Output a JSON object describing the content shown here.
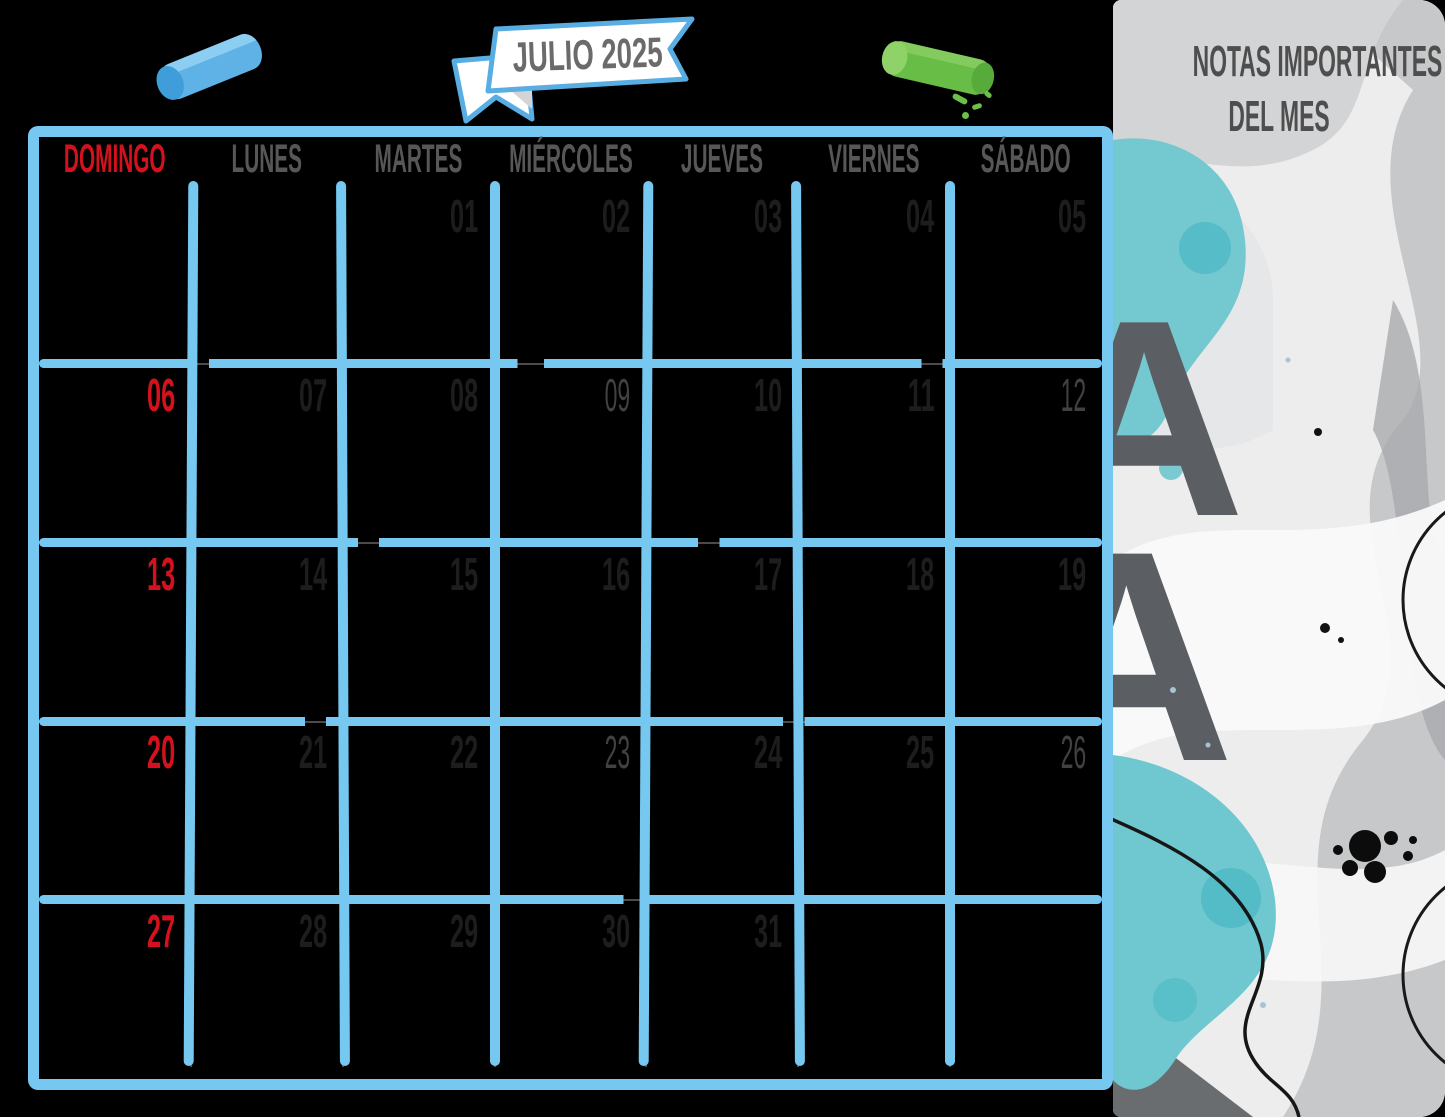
{
  "banner": {
    "title": "JULIO 2025"
  },
  "calendar": {
    "weekdays": [
      {
        "label": "DOMINGO"
      },
      {
        "label": "LUNES"
      },
      {
        "label": "MARTES"
      },
      {
        "label": "MIÉRCOLES"
      },
      {
        "label": "JUEVES"
      },
      {
        "label": "VIERNES"
      },
      {
        "label": "SÁBADO"
      }
    ],
    "weeks": [
      [
        "",
        "",
        "01",
        "02",
        "03",
        "04",
        "05"
      ],
      [
        "06",
        "07",
        "08",
        "09",
        "10",
        "11",
        "12"
      ],
      [
        "13",
        "14",
        "15",
        "16",
        "17",
        "18",
        "19"
      ],
      [
        "20",
        "21",
        "22",
        "23",
        "24",
        "25",
        "26"
      ],
      [
        "27",
        "28",
        "29",
        "30",
        "31",
        "",
        ""
      ]
    ],
    "sunday_dates": [
      "06",
      "13",
      "20",
      "27"
    ],
    "muted_dates": [
      "09",
      "12",
      "23",
      "26"
    ],
    "colors": {
      "grid_blue": "#76c8f0",
      "sunday_red": "#d5111e",
      "weekday_gray": "#575757",
      "date_dark": "#1d1d1d",
      "thin_line_gray": "#4b4b4b"
    }
  },
  "notes_panel": {
    "title_line1": "NOTAS IMPORTANTES",
    "title_line2": "DEL MES",
    "colors": {
      "teal": "#6fc8cf",
      "panel_gray": "#c7c8ca",
      "title_gray": "#4e4e4e"
    }
  },
  "decorations": {
    "blue_chalk": "blue chalk stick",
    "green_chalk": "green chalk stick with crumbs",
    "ribbon_banner": "white ribbon banner with blue outline",
    "watercolor": "gray and teal watercolor collage with letter A prints, circle outlines, ink squiggle and splatter"
  }
}
